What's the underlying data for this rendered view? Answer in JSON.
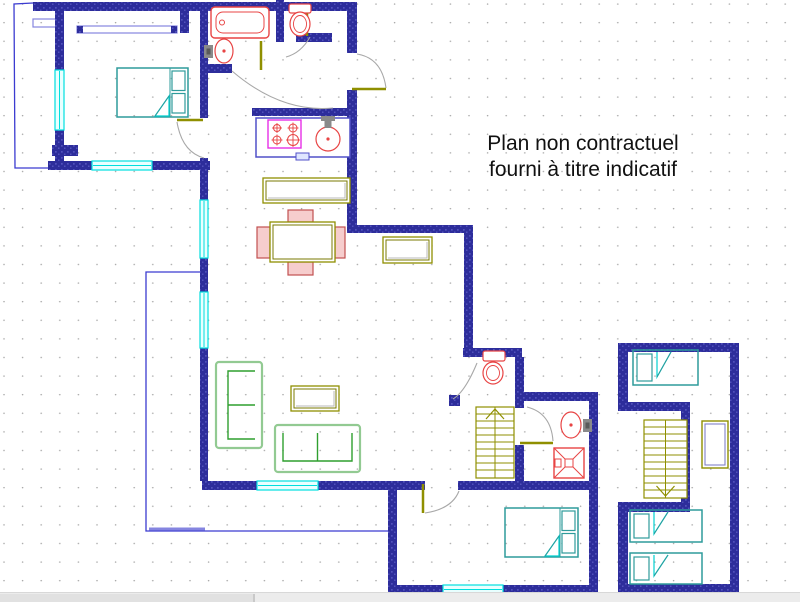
{
  "title": {
    "line1": "Plan non contractuel",
    "line2": "fourni à titre indicatif"
  },
  "canvas": {
    "w": 800,
    "h": 602,
    "drawing_h": 592
  },
  "palette": {
    "wall": "#2d2d9b",
    "wallLight": "#5252bc",
    "window": "#00dede",
    "windowFill": "#e8ffff",
    "fixture": "#e84444",
    "stove": "#e630e6",
    "door": "#8f8f00",
    "arc": "#a8a8a8",
    "sofaOuter": "#92ca92",
    "sofaInner": "#2f9f2f",
    "furn": "#8f8f00",
    "furnInner": "#7a7a00",
    "bed": "#2e9b9b",
    "fold": "#00d0d0",
    "outline": "#3b3bd0",
    "outlineLight": "#8585e0",
    "grid": "#a5a5a5",
    "counter": "#5050c8",
    "faucet": "#8a8a8a",
    "shadow": "#b8b8b8",
    "chairFill": "#f6cdcd",
    "chairStroke": "#c25050",
    "text": "#111111"
  },
  "walls": [
    [
      33,
      2,
      324,
      9
    ],
    [
      55,
      2,
      9,
      68
    ],
    [
      55,
      130,
      9,
      40
    ],
    [
      48,
      161,
      44,
      9
    ],
    [
      152,
      161,
      58,
      9
    ],
    [
      52,
      145,
      26,
      11
    ],
    [
      77,
      26,
      6,
      7
    ],
    [
      171,
      26,
      6,
      7
    ],
    [
      180,
      2,
      9,
      31
    ],
    [
      200,
      2,
      8,
      116
    ],
    [
      200,
      158,
      8,
      42
    ],
    [
      200,
      258,
      8,
      34
    ],
    [
      200,
      348,
      8,
      133
    ],
    [
      202,
      481,
      55,
      9
    ],
    [
      318,
      481,
      107,
      9
    ],
    [
      458,
      481,
      135,
      9
    ],
    [
      388,
      490,
      9,
      104
    ],
    [
      388,
      585,
      55,
      9
    ],
    [
      503,
      585,
      95,
      9
    ],
    [
      589,
      392,
      9,
      202
    ],
    [
      200,
      64,
      32,
      9
    ],
    [
      276,
      0,
      8,
      42
    ],
    [
      296,
      33,
      36,
      9
    ],
    [
      347,
      2,
      10,
      51
    ],
    [
      347,
      90,
      10,
      139
    ],
    [
      252,
      108,
      95,
      8
    ],
    [
      347,
      225,
      126,
      8
    ],
    [
      464,
      233,
      9,
      124
    ],
    [
      463,
      348,
      59,
      9
    ],
    [
      515,
      357,
      9,
      51
    ],
    [
      515,
      445,
      9,
      37
    ],
    [
      524,
      392,
      66,
      9
    ],
    [
      449,
      395,
      11,
      11
    ],
    [
      618,
      343,
      121,
      9
    ],
    [
      730,
      343,
      9,
      250
    ],
    [
      618,
      343,
      10,
      68
    ],
    [
      621,
      402,
      68,
      9
    ],
    [
      681,
      402,
      9,
      100
    ],
    [
      620,
      502,
      70,
      10
    ],
    [
      618,
      502,
      10,
      91
    ],
    [
      618,
      584,
      121,
      9
    ]
  ],
  "windows": [
    {
      "x": 55,
      "y": 70,
      "w": 9,
      "h": 60,
      "dir": "v"
    },
    {
      "x": 92,
      "y": 161,
      "w": 60,
      "h": 9,
      "dir": "h"
    },
    {
      "x": 200,
      "y": 200,
      "w": 8,
      "h": 58,
      "dir": "v"
    },
    {
      "x": 200,
      "y": 292,
      "w": 8,
      "h": 56,
      "dir": "v"
    },
    {
      "x": 257,
      "y": 481,
      "w": 61,
      "h": 9,
      "dir": "h"
    },
    {
      "x": 443,
      "y": 585,
      "w": 60,
      "h": 9,
      "dir": "h"
    }
  ],
  "door_leaves": [
    [
      177,
      120,
      203,
      120
    ],
    [
      261,
      41,
      261,
      70
    ],
    [
      307,
      10,
      307,
      36
    ],
    [
      352,
      89,
      386,
      89
    ],
    [
      520,
      443,
      553,
      443
    ],
    [
      423,
      484,
      423,
      513
    ]
  ],
  "door_arcs": [
    "M177,122 Q182,152 204,158",
    "M232,71 Q281,113 333,108",
    "M310,37 Q301,53 286,57",
    "M386,88 Q382,58 357,54",
    "M477,363 Q465,392 453,399",
    "M527,407 Q551,413 553,441",
    "M425,513 Q452,509 459,491"
  ],
  "outlines": [
    {
      "name": "balcony-outline",
      "pts": "33,3 14,4 15,168 48,168",
      "c": "outline",
      "w": 1.3
    },
    {
      "name": "balcony-rail",
      "rect": [
        33,
        19,
        27,
        8
      ],
      "c": "outlineLight",
      "w": 1.2
    },
    {
      "name": "closet-outline",
      "rect": [
        77,
        26,
        100,
        7
      ],
      "c": "outlineLight",
      "w": 1.2
    },
    {
      "name": "terrace-outline",
      "pts": "203,272 146,272 146,531 388,531",
      "c": "outline",
      "w": 1.3
    },
    {
      "name": "terrace-edge",
      "pts": "149,529 205,529",
      "c": "outlineLight",
      "w": 3
    }
  ],
  "fixtures": [
    {
      "type": "bathtub",
      "x": 211,
      "y": 7,
      "w": 58,
      "h": 31
    },
    {
      "type": "sink",
      "cx": 224,
      "cy": 51,
      "rx": 9,
      "ry": 12,
      "faucet": "left"
    },
    {
      "type": "toilet",
      "tank": [
        289,
        4,
        22,
        9
      ],
      "cx": 300,
      "cy": 24,
      "rx": 10,
      "ry": 12
    },
    {
      "type": "toilet",
      "tank": [
        483,
        351,
        22,
        10
      ],
      "cx": 493,
      "cy": 373,
      "rx": 10,
      "ry": 11
    },
    {
      "type": "sink",
      "cx": 571,
      "cy": 425,
      "rx": 10,
      "ry": 13,
      "faucet": "right"
    },
    {
      "type": "shower",
      "x": 554,
      "y": 448,
      "w": 30,
      "h": 30
    },
    {
      "type": "counter",
      "x": 256,
      "y": 118,
      "w": 94,
      "h": 39
    },
    {
      "type": "stove",
      "x": 268,
      "y": 120,
      "w": 33,
      "h": 28
    },
    {
      "type": "ksink",
      "cx": 328,
      "cy": 139,
      "rx": 12,
      "ry": 12
    }
  ],
  "furniture": [
    {
      "type": "dresser",
      "name": "sideboard",
      "x": 263,
      "y": 178,
      "w": 87,
      "h": 25
    },
    {
      "type": "table",
      "name": "dining-table",
      "x": 270,
      "y": 222,
      "w": 65,
      "h": 40,
      "chairs": [
        [
          288,
          210,
          25,
          12
        ],
        [
          288,
          262,
          25,
          13
        ],
        [
          257,
          227,
          13,
          31
        ],
        [
          335,
          227,
          10,
          31
        ]
      ]
    },
    {
      "type": "dresser",
      "name": "tv-cabinet",
      "x": 383,
      "y": 237,
      "w": 49,
      "h": 26
    },
    {
      "type": "dresser",
      "name": "coffee-table",
      "x": 291,
      "y": 386,
      "w": 48,
      "h": 25
    },
    {
      "type": "sofa",
      "name": "sofa",
      "x": 216,
      "y": 362,
      "w": 46,
      "h": 86,
      "open": "right"
    },
    {
      "type": "sofa",
      "name": "sofa",
      "x": 275,
      "y": 425,
      "w": 85,
      "h": 47,
      "open": "top"
    },
    {
      "type": "cabinet",
      "name": "shelf-cabinet",
      "x": 702,
      "y": 421,
      "w": 26,
      "h": 47
    }
  ],
  "beds": [
    {
      "kind": "double",
      "x": 117,
      "y": 68,
      "w": 71,
      "h": 49
    },
    {
      "kind": "double",
      "x": 505,
      "y": 508,
      "w": 73,
      "h": 49
    },
    {
      "kind": "single",
      "x": 633,
      "y": 350,
      "w": 65,
      "h": 35
    },
    {
      "kind": "single",
      "x": 630,
      "y": 510,
      "w": 72,
      "h": 32
    },
    {
      "kind": "single",
      "x": 630,
      "y": 553,
      "w": 72,
      "h": 31
    }
  ],
  "stairs": [
    {
      "x": 476,
      "y": 407,
      "w": 38,
      "h": 71,
      "arrow": "up"
    },
    {
      "x": 644,
      "y": 420,
      "w": 43,
      "h": 78,
      "arrow": "down"
    }
  ],
  "scrollbar": {
    "thumb_width": 253
  }
}
